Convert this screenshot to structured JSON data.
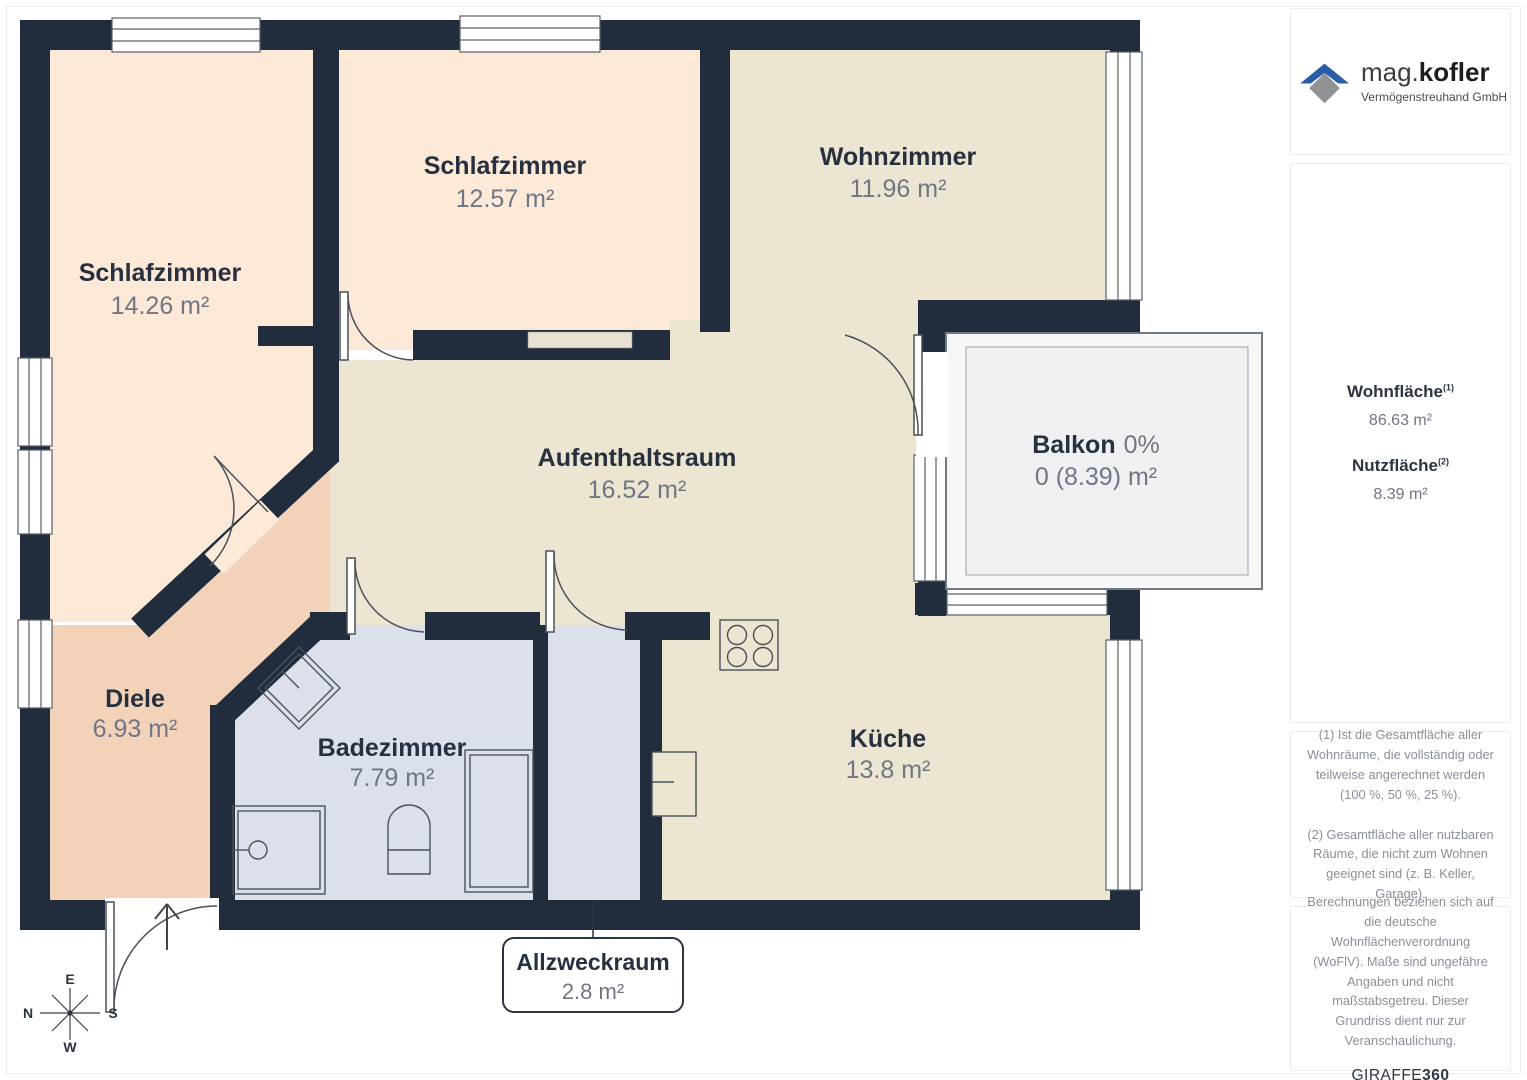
{
  "branding": {
    "name_light": "mag.",
    "name_bold": "kofler",
    "subtitle": "Vermögenstreuhand GmbH"
  },
  "metrics": {
    "wohn_label": "Wohnfläche",
    "wohn_sup": "(1)",
    "wohn_value": "86.63 m²",
    "nutz_label": "Nutzfläche",
    "nutz_sup": "(2)",
    "nutz_value": "8.39 m²"
  },
  "footnotes": {
    "f1": "(1) Ist die Gesamtfläche aller Wohnräume, die vollständig oder teilweise angerechnet werden (100 %, 50 %, 25 %).",
    "f2": "(2) Gesamtfläche aller nutzbaren Räume, die nicht zum Wohnen geeignet sind (z. B. Keller, Garage)."
  },
  "disclaimer": {
    "text": "Berechnungen beziehen sich auf die deutsche Wohnflächenverordnung (WoFlV). Maße sind ungefähre Angaben und nicht maßstabsgetreu. Dieser Grundriss dient nur zur Veranschaulichung.",
    "brand_regular": "GIRAFFE",
    "brand_bold": "360"
  },
  "compass": {
    "top": "E",
    "left": "N",
    "right": "S",
    "bottom": "W"
  },
  "rooms": [
    {
      "id": "schlafzimmer-1",
      "name": "Schlafzimmer",
      "area": "14.26 m²"
    },
    {
      "id": "schlafzimmer-2",
      "name": "Schlafzimmer",
      "area": "12.57 m²"
    },
    {
      "id": "wohnzimmer",
      "name": "Wohnzimmer",
      "area": "11.96 m²"
    },
    {
      "id": "aufenthaltsraum",
      "name": "Aufenthaltsraum",
      "area": "16.52 m²"
    },
    {
      "id": "balkon",
      "name": "Balkon",
      "percent": "0%",
      "area": "0 (8.39) m²"
    },
    {
      "id": "diele",
      "name": "Diele",
      "area": "6.93 m²"
    },
    {
      "id": "badezimmer",
      "name": "Badezimmer",
      "area": "7.79 m²"
    },
    {
      "id": "kueche",
      "name": "Küche",
      "area": "13.8 m²"
    },
    {
      "id": "allzweckraum",
      "name": "Allzweckraum",
      "area": "2.8 m²"
    }
  ],
  "colors": {
    "wall": "#212c3c",
    "floor_peach": "#fce9d8",
    "floor_cream": "#ebe5d1",
    "floor_salmon": "#f3d2ba",
    "floor_bluegray": "#dce0eb",
    "balcony_fill": "#f1f2f4",
    "label_dark": "#27303f",
    "label_gray": "#707684",
    "logo_blue": "#2a5caa",
    "logo_gray": "#909396"
  }
}
